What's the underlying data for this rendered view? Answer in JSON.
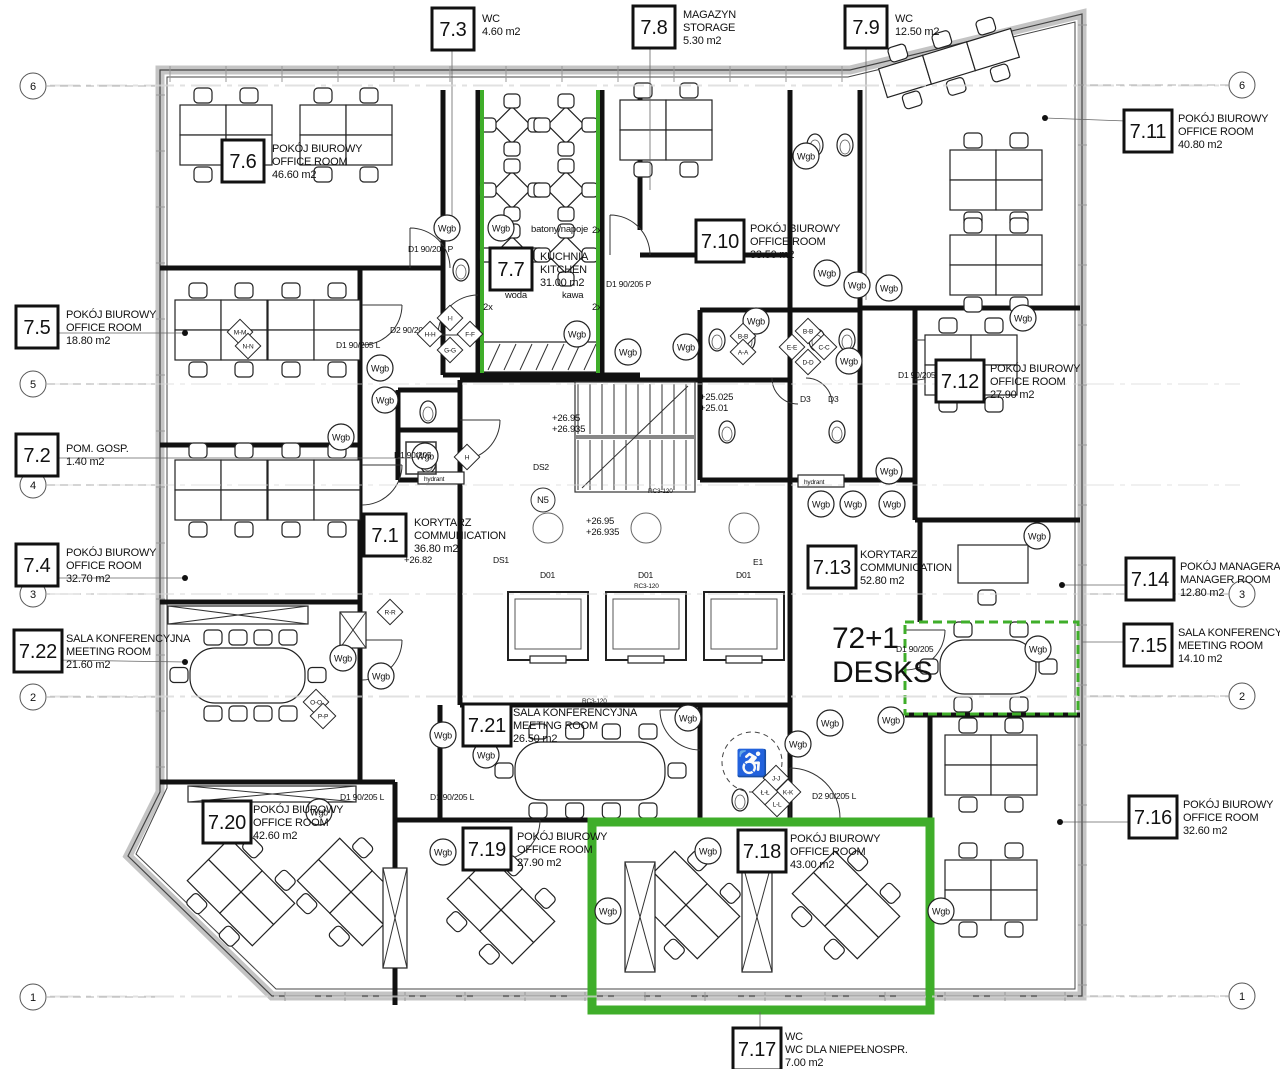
{
  "drawing": {
    "colors": {
      "highlight": "#3fae2a",
      "wall": "#111111",
      "line": "#333333",
      "grid": "#9a9a9a"
    },
    "desk_note": {
      "line1": "72+1",
      "line2": "DESKS",
      "x": 832,
      "y": 648
    },
    "rooms": [
      {
        "number": "7.3",
        "lines": [
          "WC",
          "4.60 m2"
        ],
        "x": 432,
        "y": 8,
        "tx": 482,
        "ty": 12
      },
      {
        "number": "7.8",
        "lines": [
          "MAGAZYN",
          "STORAGE",
          "5.30 m2"
        ],
        "x": 633,
        "y": 6,
        "tx": 683,
        "ty": 8
      },
      {
        "number": "7.9",
        "lines": [
          "WC",
          "12.50 m2"
        ],
        "x": 845,
        "y": 6,
        "tx": 895,
        "ty": 12
      },
      {
        "number": "7.6",
        "lines": [
          "POKÓJ BIUROWY",
          "OFFICE ROOM",
          "46.60 m2"
        ],
        "x": 222,
        "y": 140,
        "tx": 272,
        "ty": 142
      },
      {
        "number": "7.11",
        "lines": [
          "POKÓJ BIUROWY",
          "OFFICE ROOM",
          "40.80 m2"
        ],
        "x": 1124,
        "y": 110,
        "tx": 1178,
        "ty": 112
      },
      {
        "number": "7.10",
        "lines": [
          "POKÓJ BIUROWY",
          "OFFICE ROOM",
          "33.50 m2"
        ],
        "x": 696,
        "y": 220,
        "tx": 750,
        "ty": 222
      },
      {
        "number": "7.7",
        "lines": [
          "KUCHNIA",
          "KITCHEN",
          "31.00 m2"
        ],
        "x": 490,
        "y": 248,
        "tx": 540,
        "ty": 250
      },
      {
        "number": "7.5",
        "lines": [
          "POKÓJ BIUROWY",
          "OFFICE ROOM",
          "18.80 m2"
        ],
        "x": 16,
        "y": 306,
        "tx": 66,
        "ty": 308
      },
      {
        "number": "7.12",
        "lines": [
          "POKÓJ BIUROWY",
          "OFFICE ROOM",
          "27.90 m2"
        ],
        "x": 936,
        "y": 360,
        "tx": 990,
        "ty": 362
      },
      {
        "number": "7.2",
        "lines": [
          "POM. GOSP.",
          "1.40 m2"
        ],
        "x": 16,
        "y": 434,
        "tx": 66,
        "ty": 442
      },
      {
        "number": "7.1",
        "lines": [
          "KORYTARZ",
          "COMMUNICATION",
          "36.80 m2"
        ],
        "x": 364,
        "y": 514,
        "tx": 414,
        "ty": 516
      },
      {
        "number": "7.4",
        "lines": [
          "POKÓJ BIUROWY",
          "OFFICE ROOM",
          "32.70 m2"
        ],
        "x": 16,
        "y": 544,
        "tx": 66,
        "ty": 546
      },
      {
        "number": "7.13",
        "lines": [
          "KORYTARZ",
          "COMMUNICATION",
          "52.80 m2"
        ],
        "x": 808,
        "y": 546,
        "tx": 860,
        "ty": 548
      },
      {
        "number": "7.14",
        "lines": [
          "POKÓJ MANAGERA",
          "MANAGER ROOM",
          "12.80 m2"
        ],
        "x": 1126,
        "y": 558,
        "tx": 1180,
        "ty": 560
      },
      {
        "number": "7.22",
        "lines": [
          "SALA KONFERENCYJNA",
          "MEETING ROOM",
          "21.60 m2"
        ],
        "x": 14,
        "y": 630,
        "tx": 66,
        "ty": 632
      },
      {
        "number": "7.15",
        "lines": [
          "SALA KONFERENCYJNA",
          "MEETING ROOM",
          "14.10 m2"
        ],
        "x": 1124,
        "y": 624,
        "tx": 1178,
        "ty": 626
      },
      {
        "number": "7.21",
        "lines": [
          "SALA KONFERENCYJNA",
          "MEETING ROOM",
          "26.50 m2"
        ],
        "x": 463,
        "y": 704,
        "tx": 513,
        "ty": 706
      },
      {
        "number": "7.20",
        "lines": [
          "POKÓJ BIUROWY",
          "OFFICE ROOM",
          "42.60 m2"
        ],
        "x": 203,
        "y": 801,
        "tx": 253,
        "ty": 803
      },
      {
        "number": "7.16",
        "lines": [
          "POKÓJ BIUROWY",
          "OFFICE ROOM",
          "32.60 m2"
        ],
        "x": 1129,
        "y": 796,
        "tx": 1183,
        "ty": 798
      },
      {
        "number": "7.19",
        "lines": [
          "POKÓJ BIUROWY",
          "OFFICE ROOM",
          "27.90 m2"
        ],
        "x": 463,
        "y": 828,
        "tx": 517,
        "ty": 830
      },
      {
        "number": "7.18",
        "lines": [
          "POKÓJ BIUROWY",
          "OFFICE ROOM",
          "43.00 m2"
        ],
        "x": 738,
        "y": 830,
        "tx": 790,
        "ty": 832
      },
      {
        "number": "7.17",
        "lines": [
          "WC",
          "WC DLA NIEPEŁNOSPR.",
          "7.00 m2"
        ],
        "x": 733,
        "y": 1028,
        "tx": 785,
        "ty": 1030
      }
    ],
    "grid_markers": {
      "x_left": 33,
      "x_right": 1242,
      "left": [
        {
          "label": "6",
          "y": 86
        },
        {
          "label": "5",
          "y": 384
        },
        {
          "label": "4",
          "y": 485
        },
        {
          "label": "3",
          "y": 594
        },
        {
          "label": "2",
          "y": 697
        },
        {
          "label": "1",
          "y": 997
        }
      ],
      "right": [
        {
          "label": "6",
          "y": 85
        },
        {
          "label": "3",
          "y": 594
        },
        {
          "label": "2",
          "y": 696
        },
        {
          "label": "1",
          "y": 996
        }
      ]
    },
    "wgb": {
      "label": "Wgb",
      "positions": [
        [
          447,
          228
        ],
        [
          501,
          228
        ],
        [
          577,
          334
        ],
        [
          628,
          352
        ],
        [
          686,
          347
        ],
        [
          756,
          321
        ],
        [
          806,
          156
        ],
        [
          827,
          273
        ],
        [
          857,
          285
        ],
        [
          889,
          288
        ],
        [
          1023,
          318
        ],
        [
          849,
          361
        ],
        [
          889,
          471
        ],
        [
          821,
          504
        ],
        [
          853,
          504
        ],
        [
          892,
          504
        ],
        [
          1037,
          536
        ],
        [
          380,
          368
        ],
        [
          385,
          400
        ],
        [
          341,
          437
        ],
        [
          425,
          456
        ],
        [
          343,
          658
        ],
        [
          381,
          676
        ],
        [
          443,
          735
        ],
        [
          486,
          755
        ],
        [
          688,
          718
        ],
        [
          798,
          744
        ],
        [
          830,
          723
        ],
        [
          891,
          720
        ],
        [
          1038,
          649
        ],
        [
          319,
          812
        ],
        [
          443,
          852
        ],
        [
          608,
          911
        ],
        [
          708,
          851
        ],
        [
          941,
          911
        ]
      ]
    },
    "annotations": [
      {
        "t": "+26.95",
        "x": 552,
        "y": 421,
        "k": "elev"
      },
      {
        "t": "+26.935",
        "x": 552,
        "y": 432,
        "k": "elev"
      },
      {
        "t": "+25.025",
        "x": 700,
        "y": 400,
        "k": "elev"
      },
      {
        "t": "+25.01",
        "x": 700,
        "y": 411,
        "k": "elev"
      },
      {
        "t": "+26.95",
        "x": 586,
        "y": 524,
        "k": "elev"
      },
      {
        "t": "+26.935",
        "x": 586,
        "y": 535,
        "k": "elev"
      },
      {
        "t": "+26.82",
        "x": 404,
        "y": 563,
        "k": "elev"
      },
      {
        "t": "batony/napoje",
        "x": 531,
        "y": 232,
        "k": "small"
      },
      {
        "t": "woda",
        "x": 505,
        "y": 298,
        "k": "small"
      },
      {
        "t": "kawa",
        "x": 562,
        "y": 298,
        "k": "small"
      },
      {
        "t": "2x",
        "x": 592,
        "y": 233,
        "k": "small"
      },
      {
        "t": "2x",
        "x": 483,
        "y": 310,
        "k": "small"
      },
      {
        "t": "2x",
        "x": 592,
        "y": 310,
        "k": "small"
      },
      {
        "t": "N5",
        "x": 537,
        "y": 503,
        "k": "small"
      },
      {
        "t": "hydrant",
        "x": 424,
        "y": 481,
        "k": "tiny"
      },
      {
        "t": "hydrant",
        "x": 804,
        "y": 484,
        "k": "tiny"
      },
      {
        "t": "DS1",
        "x": 493,
        "y": 563,
        "k": "door"
      },
      {
        "t": "DS2",
        "x": 533,
        "y": 470,
        "k": "door"
      },
      {
        "t": "E1",
        "x": 753,
        "y": 565,
        "k": "door"
      },
      {
        "t": "D01",
        "x": 540,
        "y": 578,
        "k": "door"
      },
      {
        "t": "D01",
        "x": 638,
        "y": 578,
        "k": "door"
      },
      {
        "t": "D01",
        "x": 736,
        "y": 578,
        "k": "door"
      },
      {
        "t": "D1 90/205 P",
        "x": 408,
        "y": 252,
        "k": "door"
      },
      {
        "t": "D2 90/205 P",
        "x": 390,
        "y": 333,
        "k": "door"
      },
      {
        "t": "D1 90/205 L",
        "x": 336,
        "y": 348,
        "k": "door"
      },
      {
        "t": "D1 90/205",
        "x": 394,
        "y": 458,
        "k": "door"
      },
      {
        "t": "D1 90/205 P",
        "x": 606,
        "y": 287,
        "k": "door"
      },
      {
        "t": "D1 90/205 L",
        "x": 898,
        "y": 378,
        "k": "door"
      },
      {
        "t": "D1 90/205",
        "x": 896,
        "y": 652,
        "k": "door"
      },
      {
        "t": "D1 90/205 L",
        "x": 340,
        "y": 800,
        "k": "door"
      },
      {
        "t": "D1 90/205 L",
        "x": 430,
        "y": 800,
        "k": "door"
      },
      {
        "t": "D2 90/205 L",
        "x": 812,
        "y": 799,
        "k": "door"
      },
      {
        "t": "D3",
        "x": 800,
        "y": 402,
        "k": "door"
      },
      {
        "t": "D3",
        "x": 828,
        "y": 402,
        "k": "door"
      },
      {
        "t": "RC3-120",
        "x": 648,
        "y": 493,
        "k": "tiny"
      },
      {
        "t": "RC3-120",
        "x": 634,
        "y": 588,
        "k": "tiny"
      },
      {
        "t": "RC3-120",
        "x": 582,
        "y": 703,
        "k": "tiny"
      }
    ],
    "section_marks": [
      {
        "t": "I-I",
        "x": 450,
        "y": 318
      },
      {
        "t": "H-H",
        "x": 430,
        "y": 334
      },
      {
        "t": "F-F",
        "x": 470,
        "y": 334
      },
      {
        "t": "G-G",
        "x": 450,
        "y": 350
      },
      {
        "t": "B-B",
        "x": 743,
        "y": 336
      },
      {
        "t": "A-A",
        "x": 743,
        "y": 352
      },
      {
        "t": "B-B",
        "x": 808,
        "y": 331
      },
      {
        "t": "E-E",
        "x": 792,
        "y": 347
      },
      {
        "t": "C-C",
        "x": 824,
        "y": 347
      },
      {
        "t": "D-D",
        "x": 808,
        "y": 362
      },
      {
        "t": "M-M",
        "x": 240,
        "y": 332
      },
      {
        "t": "N-N",
        "x": 248,
        "y": 346
      },
      {
        "t": "O-O",
        "x": 316,
        "y": 702
      },
      {
        "t": "P-P",
        "x": 323,
        "y": 716
      },
      {
        "t": "R-R",
        "x": 390,
        "y": 612
      },
      {
        "t": "J-J",
        "x": 776,
        "y": 778
      },
      {
        "t": "K-K",
        "x": 788,
        "y": 792
      },
      {
        "t": "L-L",
        "x": 777,
        "y": 804
      },
      {
        "t": "Ł-Ł",
        "x": 765,
        "y": 792
      },
      {
        "t": "H",
        "x": 467,
        "y": 457
      }
    ]
  }
}
